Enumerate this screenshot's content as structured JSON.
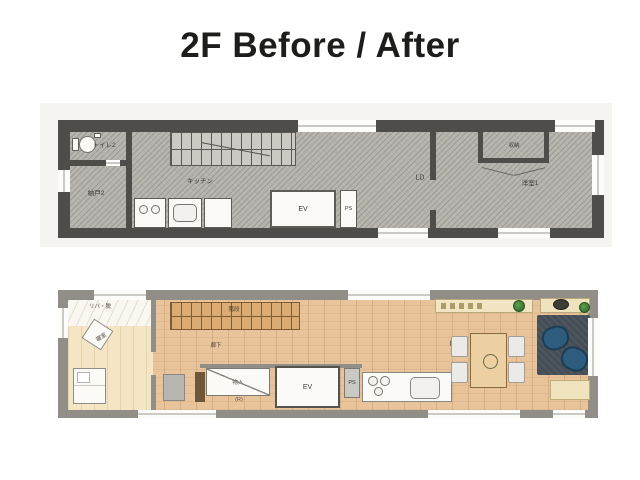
{
  "title": "2F Before / After",
  "before_plan": {
    "rooms": {
      "toilet": "トイレ2",
      "storage_room": "納戸2",
      "kitchen": "キッチン",
      "living_dining": "LD",
      "closet": "収納",
      "western_room": "洋室1",
      "elevator": "EV",
      "pipe_shaft": "PS"
    }
  },
  "after_plan": {
    "rooms": {
      "utility": "リバ・脱",
      "bedroom": "寝室",
      "stairs": "階段",
      "hallway": "廊下",
      "storage": "物入",
      "storage_note": "(R)",
      "elevator": "EV",
      "pipe_shaft": "PS",
      "ldk": "L D K"
    }
  },
  "colors": {
    "title_text": "#1d1d1b",
    "before_wall": "#4f4d49",
    "before_floor_hatch": "#b7b4ae",
    "after_wall": "#908e86",
    "after_wood_floor": "#e9c49a",
    "after_bedroom_floor": "#f4e6c4",
    "stair_wood": "#dcab72",
    "rug": "#454e56",
    "armchair_blue": "#2d5c7f",
    "plant_green": "#3f7a37"
  }
}
